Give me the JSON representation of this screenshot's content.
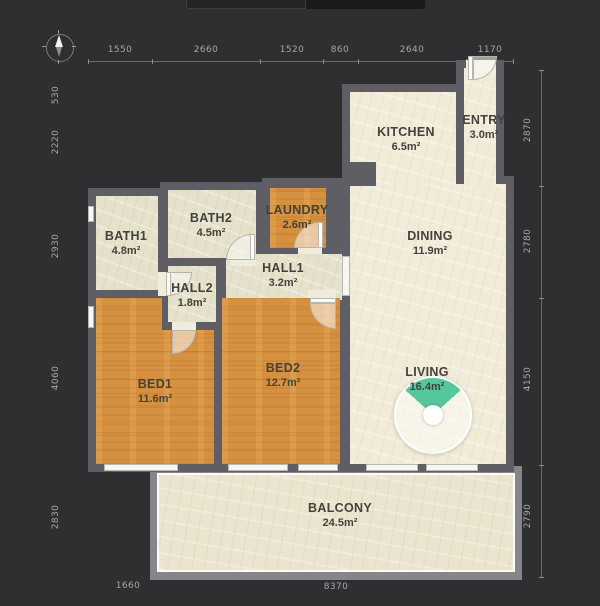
{
  "dimensions": {
    "top": [
      "1550",
      "2660",
      "1520",
      "860",
      "2640",
      "1170"
    ],
    "left": [
      "530",
      "2220",
      "2930",
      "4060",
      "2830"
    ],
    "right": [
      "2870",
      "2780",
      "4150",
      "2790"
    ],
    "bottom": [
      "1660",
      "8370"
    ]
  },
  "rooms": {
    "kitchen": {
      "name": "KITCHEN",
      "area": "6.5m²"
    },
    "entry": {
      "name": "ENTRY",
      "area": "3.0m²"
    },
    "bath1": {
      "name": "BATH1",
      "area": "4.8m²"
    },
    "bath2": {
      "name": "BATH2",
      "area": "4.5m²"
    },
    "laundry": {
      "name": "LAUNDRY",
      "area": "2.6m²"
    },
    "hall1": {
      "name": "HALL1",
      "area": "3.2m²"
    },
    "hall2": {
      "name": "HALL2",
      "area": "1.8m²"
    },
    "bed1": {
      "name": "BED1",
      "area": "11.6m²"
    },
    "bed2": {
      "name": "BED2",
      "area": "12.7m²"
    },
    "dining": {
      "name": "DINING",
      "area": "11.9m²"
    },
    "living": {
      "name": "LIVING",
      "area": "16.4m²"
    },
    "balcony": {
      "name": "BALCONY",
      "area": "24.5m²"
    }
  },
  "colors": {
    "background": "#2f2f32",
    "wall": "#5e5e64",
    "floor_cream": "#f1ebd8",
    "floor_tile": "#e5e1cb",
    "floor_wood": "#d69140",
    "balcony_wall": "#85858a",
    "accent_green": "#55c79b",
    "dim_text": "#a6a6a3"
  }
}
